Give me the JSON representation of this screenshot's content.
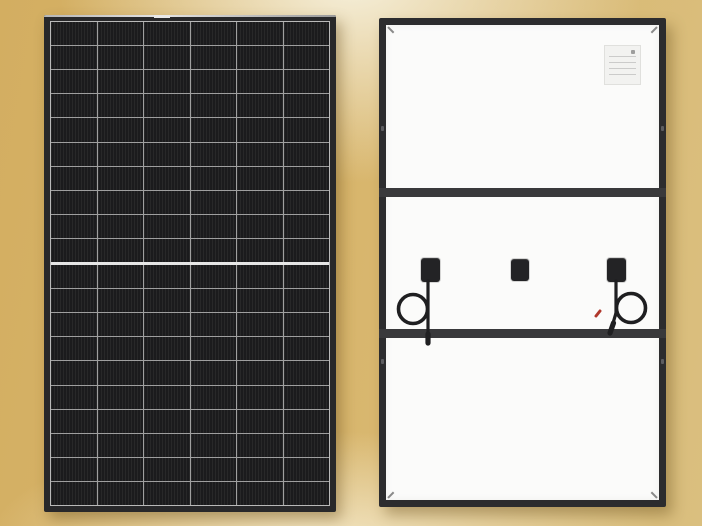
{
  "scene": {
    "description": "Product image of a solar module shown from the front (left) and the back (right) on a gold gradient backdrop",
    "background_colors": {
      "gold_left": "#d3ae61",
      "gold_right": "#dabf7f",
      "cream_highlight": "#f6f0dc"
    }
  },
  "front_panel": {
    "label": "solar panel front view",
    "columns": 6,
    "rows": 20,
    "half_cut_split_after_row": 10,
    "colors": {
      "frame": "#28282a",
      "cell": "#1b1b1d",
      "grid_line": "#9f9f9f",
      "center_divider": "#e6e6e6",
      "frame_top_highlight": "#c9c9c9"
    }
  },
  "back_panel": {
    "label": "solar panel back view",
    "rail_count": 2,
    "junction_boxes": [
      "left-with-cable-loop",
      "center",
      "right-with-cable-loop"
    ],
    "spec_label": {
      "background": "#f2f2f0",
      "text_legible": false
    },
    "colors": {
      "frame": "#2c2c2e",
      "backsheet": "#fbfbfa",
      "rail": "#39393b",
      "junction_box": "#232325",
      "cable": "#1f1f21",
      "connector_accent": "#b0382c"
    }
  }
}
